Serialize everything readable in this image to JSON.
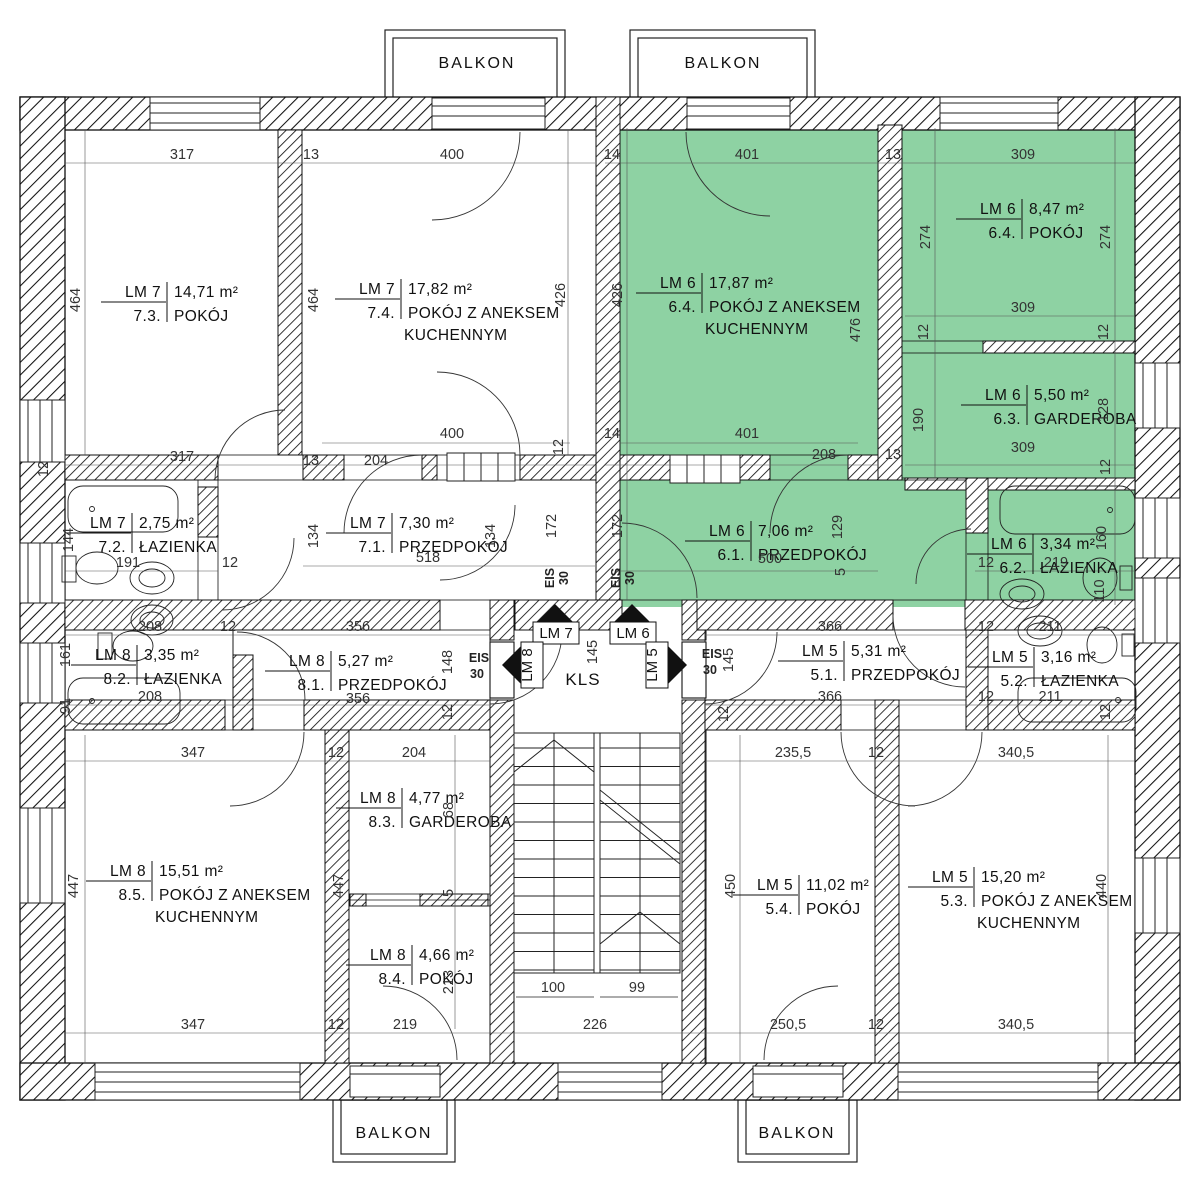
{
  "colors": {
    "highlight_green": "#8ed2a3",
    "line": "#1a1a1a",
    "dim_text": "#333333"
  },
  "balconies": [
    "BALKON",
    "BALKON",
    "BALKON",
    "BALKON"
  ],
  "stair": {
    "label": "KLS"
  },
  "labels": {
    "eis": "EIS",
    "eis_rating": "30"
  },
  "markers": [
    {
      "label": "LM 7",
      "direction": "up"
    },
    {
      "label": "LM 6",
      "direction": "up"
    },
    {
      "label": "LM 8",
      "direction": "left"
    },
    {
      "label": "LM 5",
      "direction": "right"
    }
  ],
  "rooms": [
    {
      "unit": "LM 7",
      "num": "7.3.",
      "area": "14,71 m²",
      "name": "POKÓJ",
      "x": 165,
      "y": 297
    },
    {
      "unit": "LM 7",
      "num": "7.4.",
      "area": "17,82 m²",
      "name": "POKÓJ Z ANEKSEM",
      "name2": "KUCHENNYM",
      "x": 399,
      "y": 294
    },
    {
      "unit": "LM 6",
      "num": "6.4.",
      "area": "17,87 m²",
      "name": "POKÓJ Z ANEKSEM",
      "name2": "KUCHENNYM",
      "x": 700,
      "y": 288,
      "highlighted": true
    },
    {
      "unit": "LM 6",
      "num": "6.4.",
      "area": "8,47 m²",
      "name": "POKÓJ",
      "x": 1020,
      "y": 214,
      "highlighted": true
    },
    {
      "unit": "LM 6",
      "num": "6.3.",
      "area": "5,50 m²",
      "name": "GARDEROBA",
      "x": 1025,
      "y": 400,
      "highlighted": true
    },
    {
      "unit": "LM 7",
      "num": "7.2.",
      "area": "2,75 m²",
      "name": "ŁAZIENKA",
      "x": 130,
      "y": 528
    },
    {
      "unit": "LM 7",
      "num": "7.1.",
      "area": "7,30 m²",
      "name": "PRZEDPOKÓJ",
      "x": 390,
      "y": 528
    },
    {
      "unit": "LM 6",
      "num": "6.1.",
      "area": "7,06 m²",
      "name": "PRZEDPOKÓJ",
      "x": 749,
      "y": 536,
      "highlighted": true
    },
    {
      "unit": "LM 6",
      "num": "6.2.",
      "area": "3,34 m²",
      "name": "ŁAZIENKA",
      "x": 1031,
      "y": 549,
      "highlighted": true
    },
    {
      "unit": "LM 8",
      "num": "8.2.",
      "area": "3,35 m²",
      "name": "ŁAZIENKA",
      "x": 135,
      "y": 660
    },
    {
      "unit": "LM 8",
      "num": "8.1.",
      "area": "5,27 m²",
      "name": "PRZEDPOKÓJ",
      "x": 329,
      "y": 666
    },
    {
      "unit": "LM 5",
      "num": "5.1.",
      "area": "5,31 m²",
      "name": "PRZEDPOKÓJ",
      "x": 842,
      "y": 656
    },
    {
      "unit": "LM 5",
      "num": "5.2.",
      "area": "3,16 m²",
      "name": "ŁAZIENKA",
      "x": 1032,
      "y": 662
    },
    {
      "unit": "LM 8",
      "num": "8.3.",
      "area": "4,77 m²",
      "name": "GARDEROBA",
      "x": 400,
      "y": 803
    },
    {
      "unit": "LM 8",
      "num": "8.5.",
      "area": "15,51 m²",
      "name": "POKÓJ Z ANEKSEM",
      "name2": "KUCHENNYM",
      "x": 150,
      "y": 876
    },
    {
      "unit": "LM 8",
      "num": "8.4.",
      "area": "4,66 m²",
      "name": "POKÓJ",
      "x": 410,
      "y": 960
    },
    {
      "unit": "LM 5",
      "num": "5.4.",
      "area": "11,02 m²",
      "name": "POKÓJ",
      "x": 797,
      "y": 890
    },
    {
      "unit": "LM 5",
      "num": "5.3.",
      "area": "15,20 m²",
      "name": "POKÓJ Z ANEKSEM",
      "name2": "KUCHENNYM",
      "x": 972,
      "y": 882
    }
  ],
  "dimensions": [
    {
      "t": "317",
      "x": 182,
      "y": 159
    },
    {
      "t": "13",
      "x": 311,
      "y": 159
    },
    {
      "t": "400",
      "x": 452,
      "y": 159
    },
    {
      "t": "14",
      "x": 612,
      "y": 159
    },
    {
      "t": "401",
      "x": 747,
      "y": 159
    },
    {
      "t": "13",
      "x": 893,
      "y": 159
    },
    {
      "t": "309",
      "x": 1023,
      "y": 159
    },
    {
      "t": "464",
      "x": 80,
      "y": 300,
      "r": 1
    },
    {
      "t": "464",
      "x": 318,
      "y": 300,
      "r": 1
    },
    {
      "t": "426",
      "x": 565,
      "y": 295,
      "r": 1
    },
    {
      "t": "426",
      "x": 622,
      "y": 295,
      "r": 1
    },
    {
      "t": "476",
      "x": 860,
      "y": 330,
      "r": 1
    },
    {
      "t": "274",
      "x": 930,
      "y": 237,
      "r": 1
    },
    {
      "t": "274",
      "x": 1110,
      "y": 237,
      "r": 1
    },
    {
      "t": "309",
      "x": 1023,
      "y": 312
    },
    {
      "t": "12",
      "x": 928,
      "y": 332,
      "r": 1
    },
    {
      "t": "12",
      "x": 1108,
      "y": 332,
      "r": 1
    },
    {
      "t": "190",
      "x": 923,
      "y": 420,
      "r": 1
    },
    {
      "t": "128",
      "x": 1108,
      "y": 410,
      "r": 1
    },
    {
      "t": "400",
      "x": 452,
      "y": 438
    },
    {
      "t": "14",
      "x": 612,
      "y": 438
    },
    {
      "t": "401",
      "x": 747,
      "y": 438
    },
    {
      "t": "208",
      "x": 824,
      "y": 459
    },
    {
      "t": "13",
      "x": 893,
      "y": 459
    },
    {
      "t": "309",
      "x": 1023,
      "y": 452
    },
    {
      "t": "12",
      "x": 1110,
      "y": 467,
      "r": 1
    },
    {
      "t": "317",
      "x": 182,
      "y": 461
    },
    {
      "t": "13",
      "x": 311,
      "y": 465
    },
    {
      "t": "204",
      "x": 376,
      "y": 465
    },
    {
      "t": "12",
      "x": 48,
      "y": 469,
      "r": 1
    },
    {
      "t": "12",
      "x": 563,
      "y": 447,
      "r": 1
    },
    {
      "t": "191",
      "x": 128,
      "y": 567
    },
    {
      "t": "12",
      "x": 230,
      "y": 567
    },
    {
      "t": "144",
      "x": 73,
      "y": 540,
      "r": 1
    },
    {
      "t": "134",
      "x": 318,
      "y": 536,
      "r": 1
    },
    {
      "t": "518",
      "x": 428,
      "y": 562
    },
    {
      "t": "134",
      "x": 495,
      "y": 536,
      "r": 1
    },
    {
      "t": "172",
      "x": 556,
      "y": 526,
      "r": 1
    },
    {
      "t": "172",
      "x": 622,
      "y": 526,
      "r": 1
    },
    {
      "t": "500",
      "x": 770,
      "y": 563
    },
    {
      "t": "129",
      "x": 842,
      "y": 527,
      "r": 1
    },
    {
      "t": "5",
      "x": 845,
      "y": 572,
      "r": 1
    },
    {
      "t": "12",
      "x": 986,
      "y": 567
    },
    {
      "t": "219",
      "x": 1056,
      "y": 567
    },
    {
      "t": "160",
      "x": 1106,
      "y": 538,
      "r": 1
    },
    {
      "t": "110",
      "x": 1104,
      "y": 591,
      "r": 1
    },
    {
      "t": "208",
      "x": 150,
      "y": 631
    },
    {
      "t": "12",
      "x": 228,
      "y": 631
    },
    {
      "t": "356",
      "x": 358,
      "y": 631
    },
    {
      "t": "366",
      "x": 830,
      "y": 631
    },
    {
      "t": "12",
      "x": 986,
      "y": 631
    },
    {
      "t": "211",
      "x": 1050,
      "y": 631
    },
    {
      "t": "148",
      "x": 452,
      "y": 662,
      "r": 1
    },
    {
      "t": "145",
      "x": 597,
      "y": 652,
      "r": 1
    },
    {
      "t": "145",
      "x": 733,
      "y": 660,
      "r": 1
    },
    {
      "t": "161",
      "x": 70,
      "y": 655,
      "r": 1
    },
    {
      "t": "91",
      "x": 70,
      "y": 706,
      "r": 1
    },
    {
      "t": "208",
      "x": 150,
      "y": 701
    },
    {
      "t": "356",
      "x": 358,
      "y": 703
    },
    {
      "t": "12",
      "x": 452,
      "y": 712,
      "r": 1
    },
    {
      "t": "366",
      "x": 830,
      "y": 701
    },
    {
      "t": "12",
      "x": 986,
      "y": 701
    },
    {
      "t": "211",
      "x": 1050,
      "y": 701
    },
    {
      "t": "12",
      "x": 1110,
      "y": 712,
      "r": 1
    },
    {
      "t": "12",
      "x": 728,
      "y": 714,
      "r": 1
    },
    {
      "t": "347",
      "x": 193,
      "y": 757
    },
    {
      "t": "12",
      "x": 336,
      "y": 757
    },
    {
      "t": "204",
      "x": 414,
      "y": 757
    },
    {
      "t": "235,5",
      "x": 793,
      "y": 757
    },
    {
      "t": "12",
      "x": 876,
      "y": 757
    },
    {
      "t": "340,5",
      "x": 1016,
      "y": 757
    },
    {
      "t": "447",
      "x": 78,
      "y": 886,
      "r": 1
    },
    {
      "t": "447",
      "x": 343,
      "y": 886,
      "r": 1
    },
    {
      "t": "450",
      "x": 735,
      "y": 886,
      "r": 1
    },
    {
      "t": "440",
      "x": 1106,
      "y": 886,
      "r": 1
    },
    {
      "t": "68",
      "x": 453,
      "y": 810,
      "r": 1
    },
    {
      "t": "5",
      "x": 453,
      "y": 893,
      "r": 1
    },
    {
      "t": "213",
      "x": 453,
      "y": 982,
      "r": 1
    },
    {
      "t": "100",
      "x": 553,
      "y": 992
    },
    {
      "t": "99",
      "x": 637,
      "y": 992
    },
    {
      "t": "347",
      "x": 193,
      "y": 1029
    },
    {
      "t": "12",
      "x": 336,
      "y": 1029
    },
    {
      "t": "219",
      "x": 405,
      "y": 1029
    },
    {
      "t": "226",
      "x": 595,
      "y": 1029
    },
    {
      "t": "250,5",
      "x": 788,
      "y": 1029
    },
    {
      "t": "12",
      "x": 876,
      "y": 1029
    },
    {
      "t": "340,5",
      "x": 1016,
      "y": 1029
    }
  ]
}
